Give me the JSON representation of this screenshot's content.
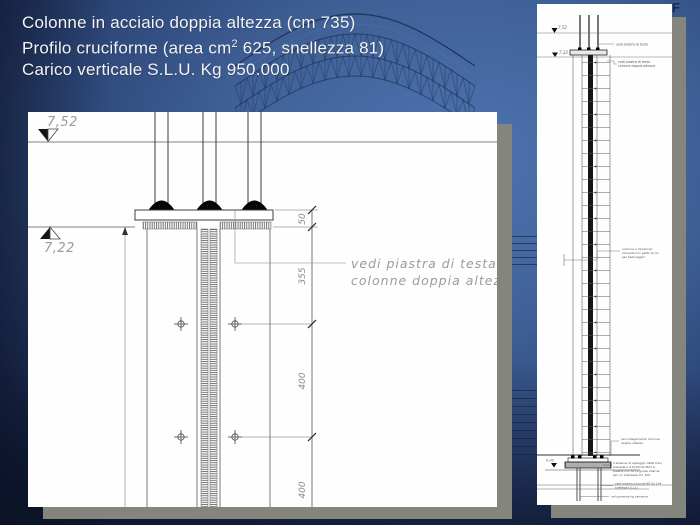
{
  "title": {
    "line1": "Colonne in acciaio doppia altezza (cm 735)",
    "line2_pre": "Profilo cruciforme (area cm",
    "line2_sup": "2",
    "line2_post": " 625, snellezza 81)",
    "line3": "Carico verticale S.L.U. Kg 950.000"
  },
  "main_drawing": {
    "level_upper": "7,52",
    "level_lower": "7,22",
    "dim_50": "50",
    "dim_355": "355",
    "dim_400a": "400",
    "dim_400b": "400",
    "note_line1": "vedi piastra di testa",
    "note_line2": "colonne doppia altezza"
  },
  "side_drawing": {
    "level_upper": "7,52",
    "level_lower": "7,22",
    "level_base": "0,00",
    "note_top": "vedi piastra di testa",
    "note_head": [
      "vedi piastra di testa",
      "colonne doppia altezza"
    ],
    "note_mid": [
      "colonna a 'tampone'",
      "riempita con getto di cls",
      "per betonaggio"
    ],
    "note_joint": [
      "nel collegamento colonne",
      "doppia altezza"
    ],
    "note_base_plate": [
      "il sistema di appoggio delle travi",
      "prevede n.4 tirafondi M24 e",
      "piastre con fori e guide interne",
      "per un interasse tot. 520"
    ],
    "note_anchor": [
      "vedi piastra colonne 60 5x 1x4",
      "snellezza S.L.U."
    ],
    "note_grout": "nel portante kg cemento"
  },
  "background": {
    "corner_glyph": "F"
  },
  "colors": {
    "background_light": "#4e74b0",
    "background_dark": "#141f3c",
    "panel": "#fefefe",
    "shadow": "#84867e",
    "line_dark": "#3c3c3c",
    "cad_gray": "#9a9a9a"
  }
}
